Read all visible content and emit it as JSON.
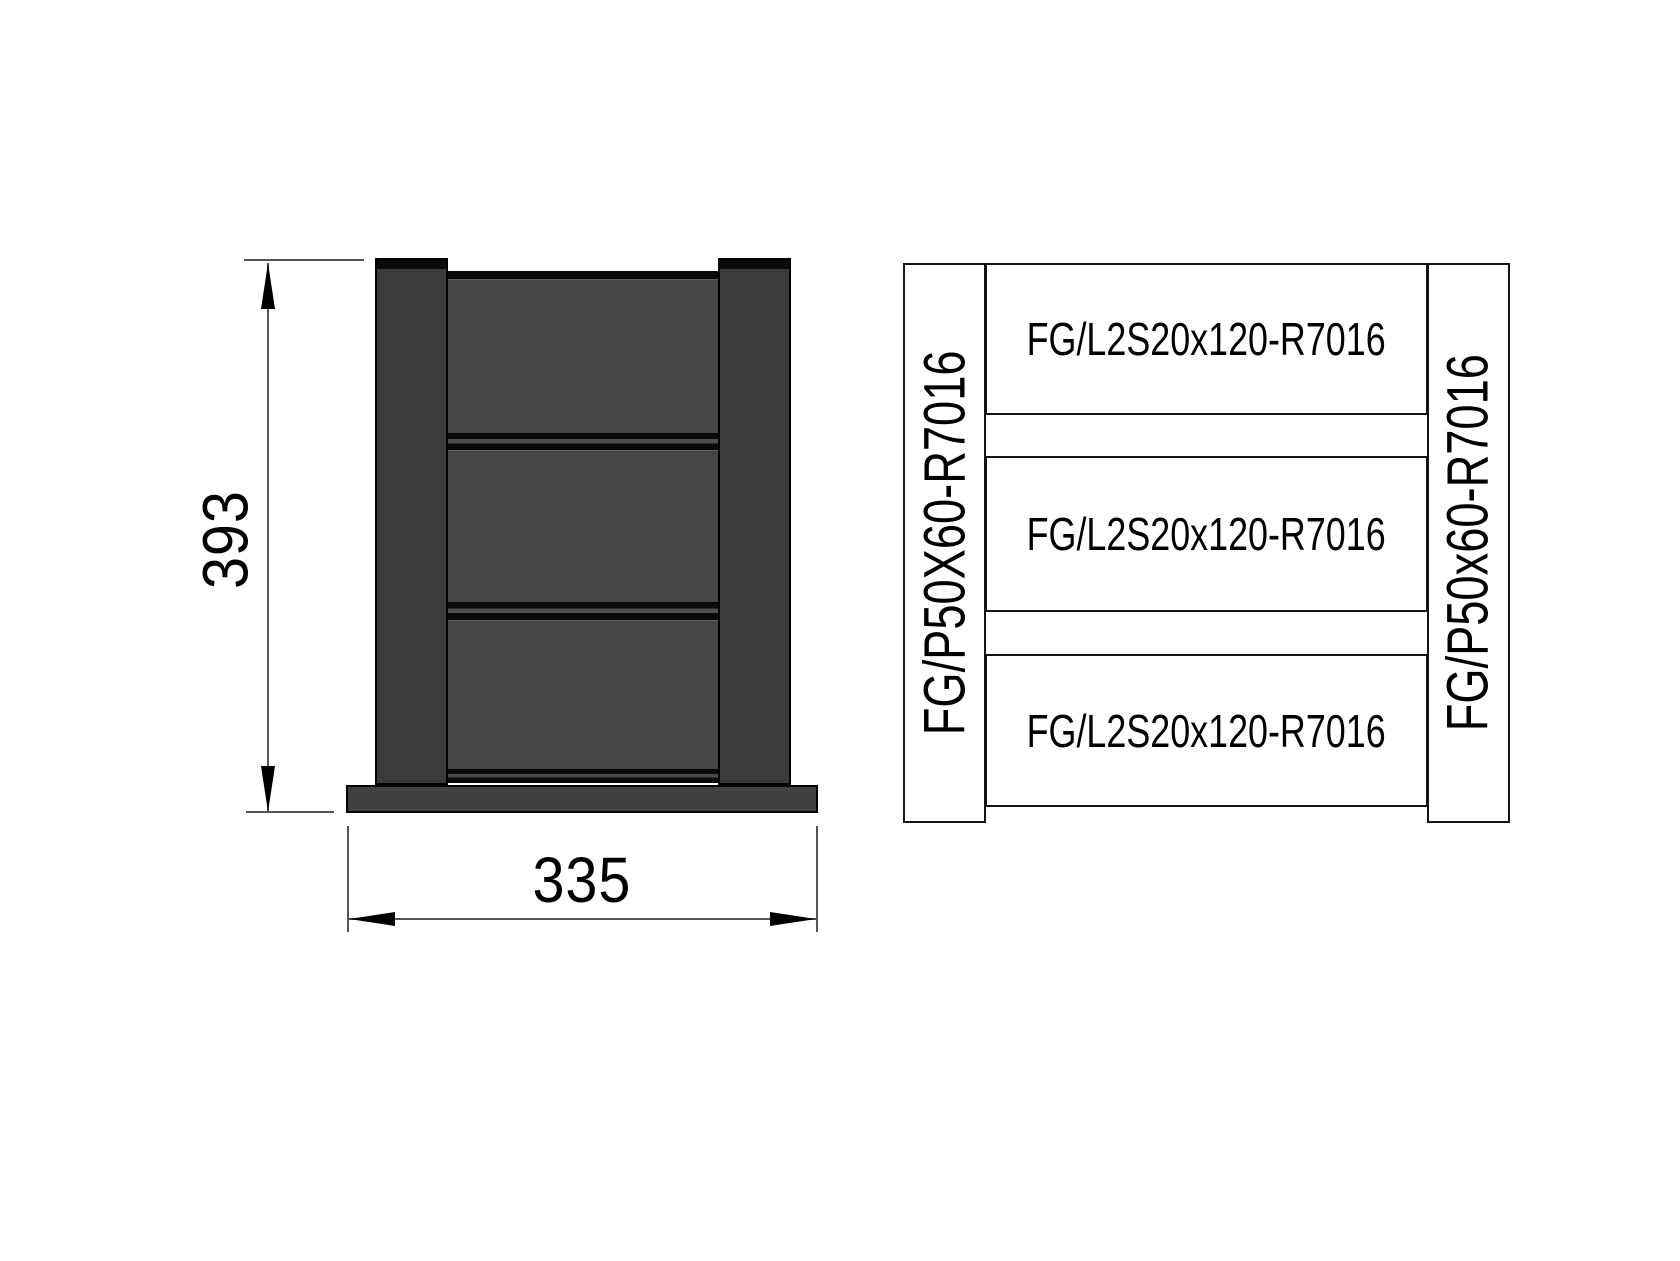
{
  "elevation": {
    "height_dim": "393",
    "width_dim": "335",
    "boards_count": 3,
    "colors": {
      "post": "#3b3b3d",
      "board": "#464648",
      "base_plate": "#414143",
      "rail_dark": "#0a0a0a",
      "rail_mid": "#4e4e50",
      "outline": "#000000"
    }
  },
  "schematic": {
    "left_post_label": "FG/P50X60-R7016",
    "right_post_label": "FG/P50x60-R7016",
    "rail_labels": [
      "FG/L2S20x120-R7016",
      "FG/L2S20x120-R7016",
      "FG/L2S20x120-R7016"
    ],
    "line_color": "#141414"
  }
}
